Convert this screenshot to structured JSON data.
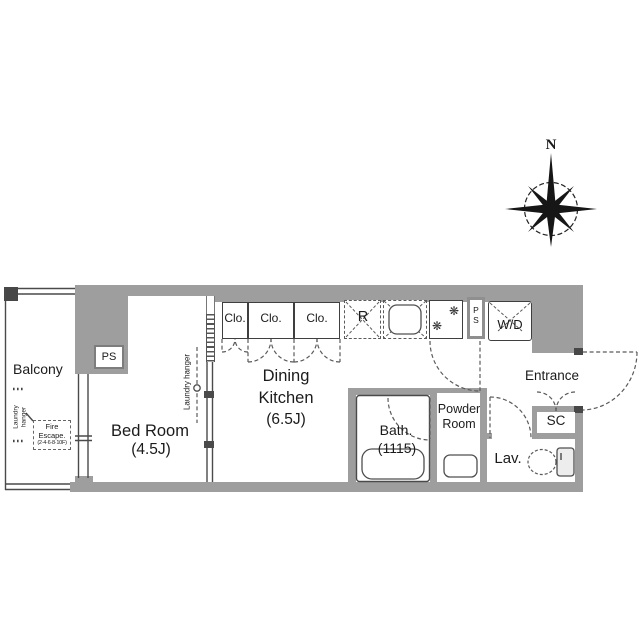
{
  "meta": {
    "type": "apartment-floor-plan",
    "wall_color": "#9e9e9e"
  },
  "compass": {
    "north_label": "N"
  },
  "balcony": {
    "label": "Balcony",
    "laundry": {
      "line1": "Laundry",
      "line2": "hanger"
    },
    "fire_escape": {
      "line1": "Fire",
      "line2": "Escape.",
      "line3": "(2·4·6·8·10F)"
    }
  },
  "rooms": {
    "bedroom": {
      "name": "Bed Room",
      "size": "(4.5J)",
      "ps_label": "PS",
      "laundry_hanger": "Laundry hanger"
    },
    "dining_kitchen": {
      "name_line1": "Dining",
      "name_line2": "Kitchen",
      "size": "(6.5J)"
    },
    "bath": {
      "name": "Bath.",
      "size": "(1115)"
    },
    "powder_room": {
      "name_line1": "Powder",
      "name_line2": "Room"
    },
    "lavatory": {
      "name": "Lav."
    },
    "entrance": {
      "name": "Entrance",
      "shoe_closet": "SC"
    }
  },
  "fixtures": {
    "closets": [
      "Clo.",
      "Clo.",
      "Clo."
    ],
    "refrigerator": "R",
    "washer_dryer": "W/D",
    "pipe_space": {
      "line1": "P",
      "line2": "S"
    },
    "burner_icon": "❋"
  }
}
